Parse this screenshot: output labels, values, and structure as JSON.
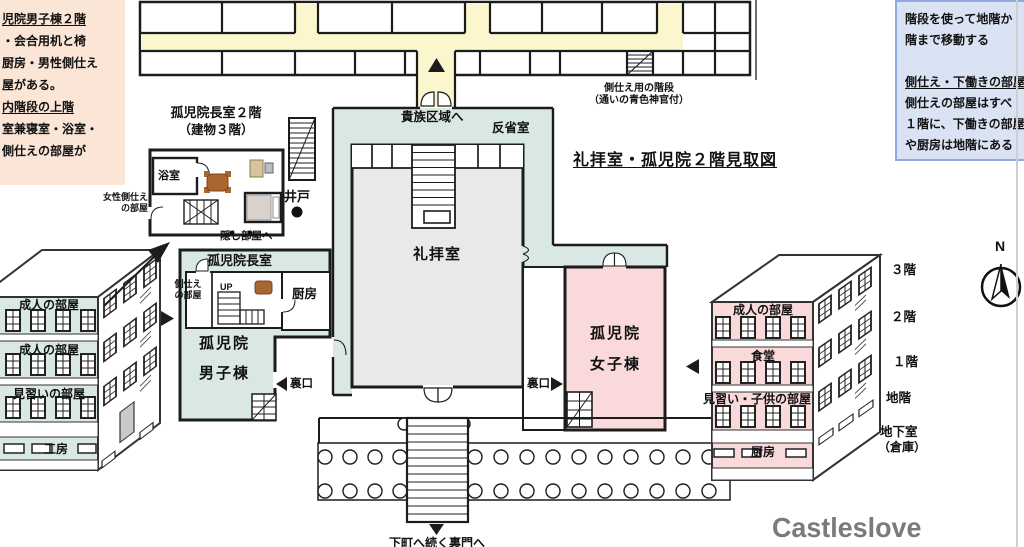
{
  "title": "礼拝室・孤児院２階見取図",
  "watermark": "Castleslove",
  "compass_north": "N",
  "colors": {
    "teal": "#d9e8e4",
    "pink": "#f9d9da",
    "yellow": "#fbf6cd",
    "peach": "#fbe5d6",
    "note_blue": "#dae3f3",
    "note_blue_border": "#8faadc",
    "chapel_grey": "#e9e9e9",
    "wall": "#1c1c1c",
    "table_brown": "#a9662f",
    "watermark_grey": "#7b7b7b"
  },
  "note_boys": {
    "line1": "児院男子棟２階",
    "line2": "・会合用机と椅",
    "line3": "厨房・男性側仕え",
    "line4": "屋がある。",
    "line5": "内階段の上階",
    "line6": "室兼寝室・浴室・",
    "line7": "側仕えの部屋が"
  },
  "note_servants": {
    "line1": "階段を使って地階か",
    "line2": "階まで移動する",
    "line3": "側仕え・下働きの部屋",
    "line4": "側仕えの部屋はすべ",
    "line5": "１階に、下働きの部屋",
    "line6": "や厨房は地階にある"
  },
  "director_detail": {
    "title_line1": "孤児院長室２階",
    "title_line2": "（建物３階）",
    "bath": "浴室",
    "female_servant_line1": "女性側仕え",
    "female_servant_line2": "の部屋",
    "hidden_room": "隠し部屋へ",
    "well": "井戸"
  },
  "main_floor": {
    "noble_area": "貴族区域へ",
    "reflection_room": "反省室",
    "servant_stairs_line1": "側仕え用の階段",
    "servant_stairs_line2": "（通いの青色神官付）",
    "chapel": "礼拝室",
    "director_office": "孤児院長室",
    "servant_room_line1": "側仕え",
    "servant_room_line2": "の部屋",
    "up": "UP",
    "kitchen": "厨房",
    "boys_line1": "孤児院",
    "boys_line2": "男子棟",
    "girls_line1": "孤児院",
    "girls_line2": "女子棟",
    "back_door_left": "裏口",
    "back_door_right": "裏口",
    "gate": "下町へ続く裏門へ"
  },
  "boys_building": {
    "floors": [
      "成人の部屋",
      "成人の部屋",
      "見習いの部屋",
      "工房"
    ]
  },
  "girls_building": {
    "floors": [
      "成人の部屋",
      "食堂",
      "見習い・子供の部屋",
      "厨房"
    ]
  },
  "floor_scale": {
    "f3": "３階",
    "f2": "２階",
    "f1": "１階",
    "fb": "地階",
    "basement_line1": "地下室",
    "basement_line2": "（倉庫）"
  }
}
